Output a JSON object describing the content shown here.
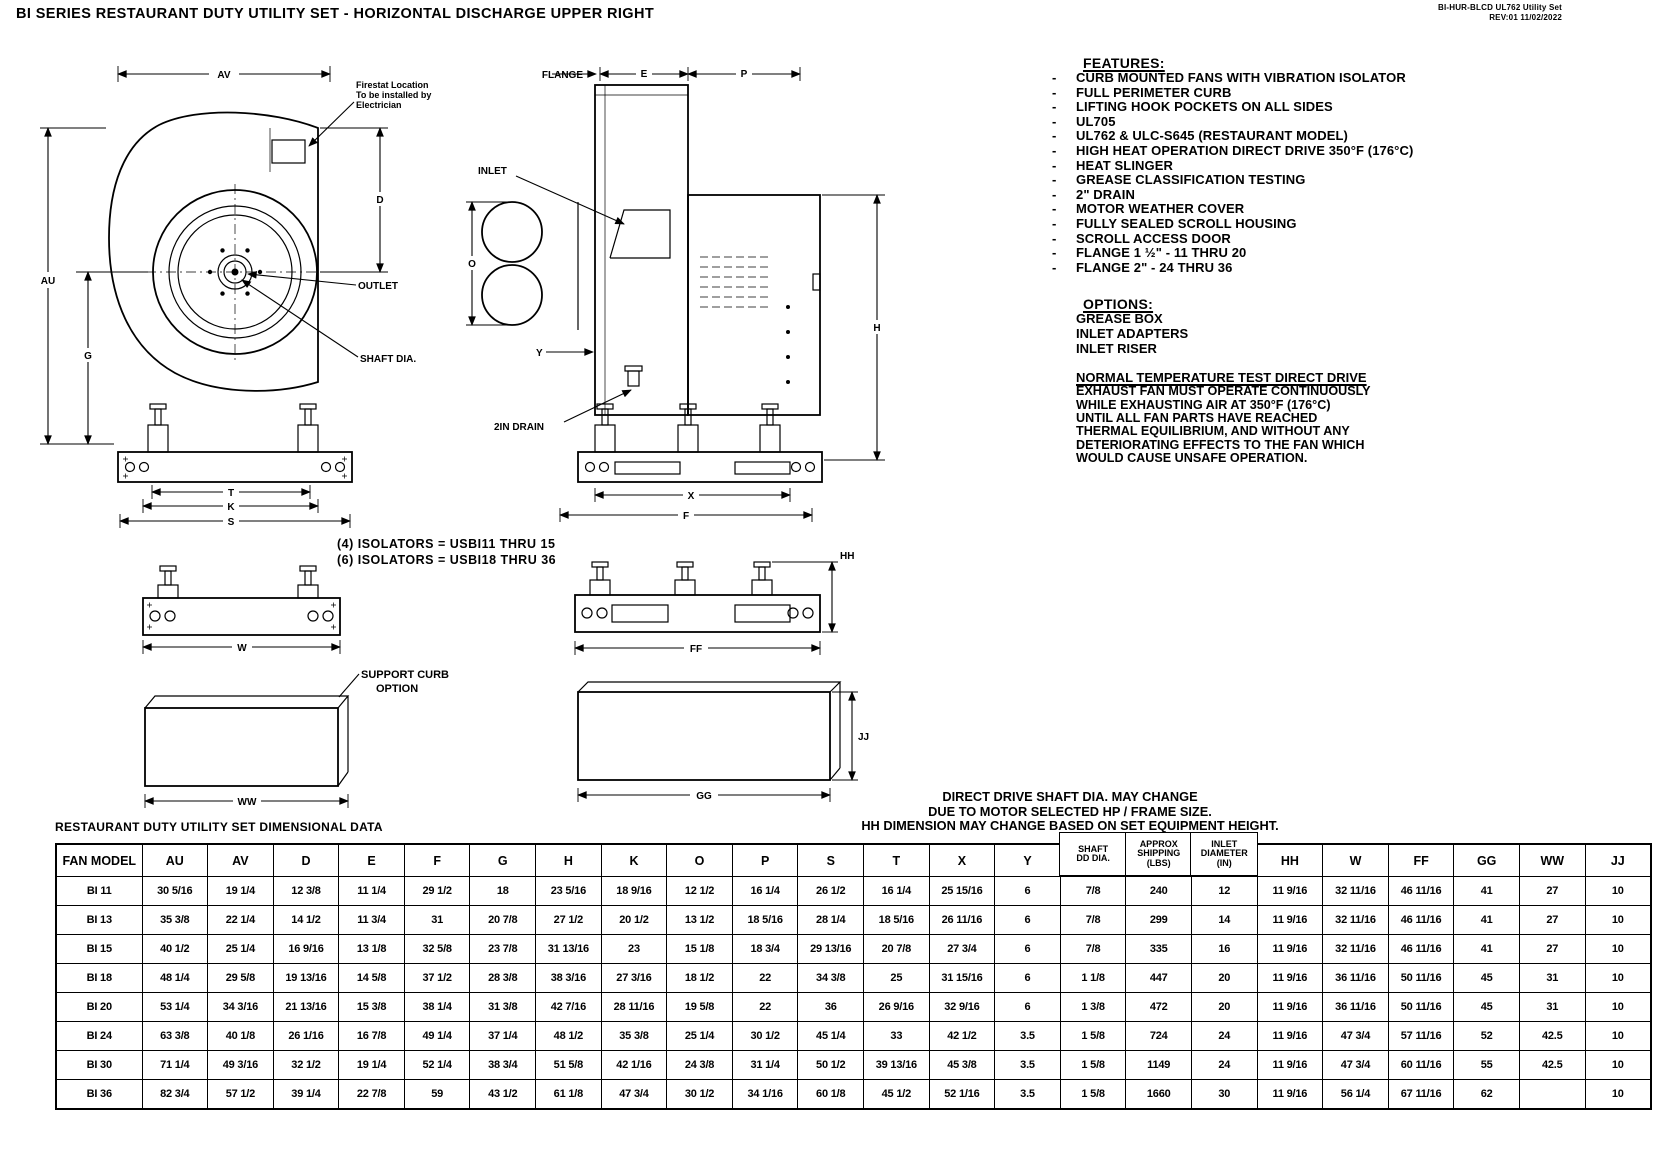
{
  "header": {
    "title": "BI SERIES RESTAURANT DUTY UTILITY SET - HORIZONTAL DISCHARGE UPPER RIGHT",
    "doc_line1": "BI-HUR-BLCD UL762 Utility Set",
    "doc_line2": "REV:01   11/02/2022"
  },
  "features": {
    "heading": "FEATURES:",
    "items": [
      "CURB MOUNTED FANS WITH VIBRATION ISOLATOR",
      "FULL PERIMETER CURB",
      "LIFTING HOOK POCKETS ON ALL SIDES",
      "UL705",
      "UL762 & ULC-S645 (RESTAURANT MODEL)",
      "HIGH HEAT OPERATION DIRECT DRIVE 350°F (176°C)",
      "HEAT SLINGER",
      "GREASE CLASSIFICATION TESTING",
      "2\" DRAIN",
      "MOTOR WEATHER COVER",
      "FULLY SEALED SCROLL HOUSING",
      "SCROLL ACCESS DOOR",
      "FLANGE 1 ½\" - 11 THRU 20",
      "FLANGE 2\" - 24 THRU 36"
    ]
  },
  "options": {
    "heading": "OPTIONS:",
    "items": [
      "GREASE BOX",
      "INLET ADAPTERS",
      "INLET RISER"
    ]
  },
  "normal_test": {
    "heading": "NORMAL TEMPERATURE TEST DIRECT DRIVE",
    "lines": [
      "EXHAUST FAN MUST OPERATE CONTINUOUSLY",
      "WHILE EXHAUSTING AIR AT 350°F (176°C)",
      "UNTIL ALL FAN PARTS HAVE REACHED",
      "THERMAL EQUILIBRIUM, AND WITHOUT ANY",
      "DETERIORATING EFFECTS TO THE FAN WHICH",
      "WOULD CAUSE UNSAFE OPERATION."
    ]
  },
  "notes": {
    "isolators": [
      "(4) ISOLATORS = USBI11 THRU 15",
      "(6) ISOLATORS = USBI18 THRU 36"
    ],
    "shaft_note": [
      "DIRECT DRIVE SHAFT DIA. MAY CHANGE",
      "DUE TO MOTOR SELECTED HP / FRAME SIZE.",
      "HH DIMENSION MAY CHANGE BASED ON SET EQUIPMENT HEIGHT."
    ]
  },
  "drawings": {
    "side": {
      "av": "AV",
      "au": "AU",
      "g": "G",
      "d": "D",
      "t": "T",
      "k": "K",
      "s": "S",
      "firestat": [
        "Firestat Location",
        "To be installed by",
        "Electrician"
      ],
      "outlet": "OUTLET",
      "shaft_dia": "SHAFT DIA."
    },
    "front": {
      "flange": "FLANGE",
      "e": "E",
      "p": "P",
      "o": "O",
      "h": "H",
      "y": "Y",
      "x": "X",
      "f": "F",
      "inlet": "INLET",
      "drain": "2IN DRAIN"
    },
    "rail_small": {
      "w": "W"
    },
    "rail_large": {
      "hh": "HH",
      "ff": "FF"
    },
    "curb_small": {
      "ww": "WW",
      "label": [
        "SUPPORT CURB",
        "OPTION"
      ]
    },
    "curb_large": {
      "gg": "GG",
      "jj": "JJ"
    }
  },
  "table": {
    "title": "RESTAURANT DUTY UTILITY SET DIMENSIONAL DATA",
    "columns": [
      "FAN MODEL",
      "AU",
      "AV",
      "D",
      "E",
      "F",
      "G",
      "H",
      "K",
      "O",
      "P",
      "S",
      "T",
      "X",
      "Y",
      "SHAFT\nDD DIA.",
      "APPROX\nSHIPPING\n(LBS)",
      "INLET\nDIAMETER\n(IN)",
      "HH",
      "W",
      "FF",
      "GG",
      "WW",
      "JJ"
    ],
    "rows": [
      [
        "BI 11",
        "30 5/16",
        "19 1/4",
        "12 3/8",
        "11 1/4",
        "29 1/2",
        "18",
        "23 5/16",
        "18 9/16",
        "12 1/2",
        "16 1/4",
        "26 1/2",
        "16 1/4",
        "25 15/16",
        "6",
        "7/8",
        "240",
        "12",
        "11 9/16",
        "32 11/16",
        "46 11/16",
        "41",
        "27",
        "10"
      ],
      [
        "BI 13",
        "35 3/8",
        "22 1/4",
        "14 1/2",
        "11 3/4",
        "31",
        "20 7/8",
        "27 1/2",
        "20 1/2",
        "13 1/2",
        "18 5/16",
        "28 1/4",
        "18 5/16",
        "26 11/16",
        "6",
        "7/8",
        "299",
        "14",
        "11 9/16",
        "32 11/16",
        "46 11/16",
        "41",
        "27",
        "10"
      ],
      [
        "BI 15",
        "40 1/2",
        "25 1/4",
        "16 9/16",
        "13 1/8",
        "32 5/8",
        "23 7/8",
        "31 13/16",
        "23",
        "15 1/8",
        "18 3/4",
        "29 13/16",
        "20 7/8",
        "27 3/4",
        "6",
        "7/8",
        "335",
        "16",
        "11 9/16",
        "32 11/16",
        "46 11/16",
        "41",
        "27",
        "10"
      ],
      [
        "BI 18",
        "48 1/4",
        "29 5/8",
        "19 13/16",
        "14 5/8",
        "37 1/2",
        "28 3/8",
        "38 3/16",
        "27 3/16",
        "18 1/2",
        "22",
        "34 3/8",
        "25",
        "31 15/16",
        "6",
        "1 1/8",
        "447",
        "20",
        "11 9/16",
        "36 11/16",
        "50 11/16",
        "45",
        "31",
        "10"
      ],
      [
        "BI 20",
        "53 1/4",
        "34 3/16",
        "21 13/16",
        "15 3/8",
        "38 1/4",
        "31 3/8",
        "42 7/16",
        "28 11/16",
        "19 5/8",
        "22",
        "36",
        "26 9/16",
        "32 9/16",
        "6",
        "1 3/8",
        "472",
        "20",
        "11 9/16",
        "36 11/16",
        "50 11/16",
        "45",
        "31",
        "10"
      ],
      [
        "BI 24",
        "63 3/8",
        "40 1/8",
        "26 1/16",
        "16 7/8",
        "49 1/4",
        "37 1/4",
        "48 1/2",
        "35 3/8",
        "25 1/4",
        "30 1/2",
        "45 1/4",
        "33",
        "42 1/2",
        "3.5",
        "1 5/8",
        "724",
        "24",
        "11 9/16",
        "47 3/4",
        "57 11/16",
        "52",
        "42.5",
        "10"
      ],
      [
        "BI 30",
        "71 1/4",
        "49 3/16",
        "32 1/2",
        "19 1/4",
        "52 1/4",
        "38 3/4",
        "51 5/8",
        "42 1/16",
        "24 3/8",
        "31 1/4",
        "50 1/2",
        "39 13/16",
        "45 3/8",
        "3.5",
        "1 5/8",
        "1149",
        "24",
        "11 9/16",
        "47 3/4",
        "60 11/16",
        "55",
        "42.5",
        "10"
      ],
      [
        "BI 36",
        "82 3/4",
        "57 1/2",
        "39 1/4",
        "22 7/8",
        "59",
        "43 1/2",
        "61 1/8",
        "47 3/4",
        "30 1/2",
        "34 1/16",
        "60 1/8",
        "45 1/2",
        "52 1/16",
        "3.5",
        "1 5/8",
        "1660",
        "30",
        "11 9/16",
        "56 1/4",
        "67 11/16",
        "62",
        "",
        "10"
      ]
    ]
  }
}
